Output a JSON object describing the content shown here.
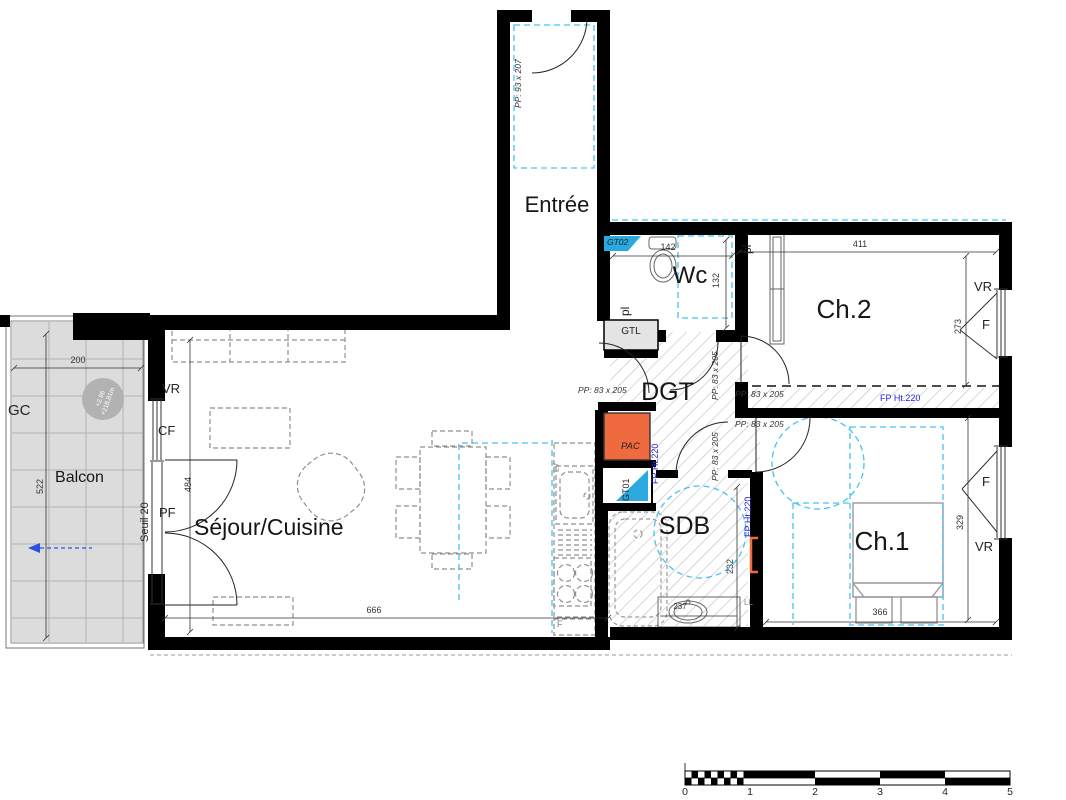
{
  "rooms": {
    "entree": "Entrée",
    "wc": "Wc",
    "ch2": "Ch.2",
    "dgt": "DGT",
    "balcon": "Balcon",
    "sejour": "Séjour/Cuisine",
    "sdb": "SDB",
    "ch1": "Ch.1"
  },
  "doors": {
    "entry": "PP: 93 x 207",
    "interior": "PP: 83 x 205"
  },
  "equipment": {
    "gtl": "GTL",
    "gt01": "GT01",
    "gt02": "GT02",
    "pac": "PAC",
    "lv": "LV",
    "ll": "LL",
    "fp": "FP Ht.220"
  },
  "openings": {
    "vr": "VR",
    "cf": "CF",
    "pf": "PF",
    "f": "F",
    "pl": "pl",
    "seuil": "Seuil 20",
    "gc": "GC"
  },
  "levels": {
    "relative": "+2.96",
    "absolute": "+218,81m"
  },
  "dimensions": {
    "balcony_width": "200",
    "balcony_length": "522",
    "bay_height": "484",
    "sejour_width": "666",
    "wc_width": "142",
    "wc_depth": "132",
    "ch2_width": "411",
    "ch2_depth": "273",
    "ch1_width": "366",
    "ch1_depth": "329",
    "sdb_depth": "232",
    "sdb_width": "237"
  },
  "scalebar": {
    "labels": [
      "0",
      "1",
      "2",
      "3",
      "4",
      "5"
    ]
  }
}
